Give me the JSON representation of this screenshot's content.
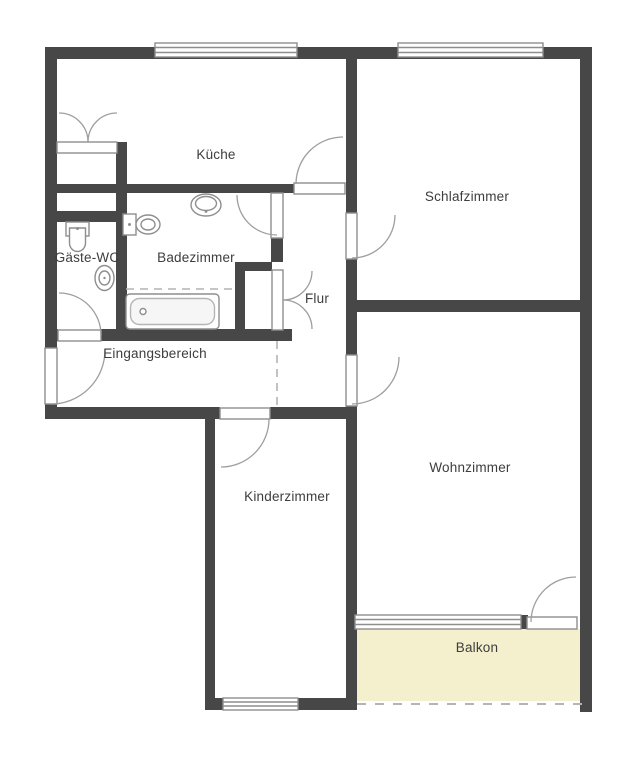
{
  "plan": {
    "type": "apartment-floorplan",
    "rooms": {
      "kueche": {
        "label": "Küche"
      },
      "schlafzimmer": {
        "label": "Schlafzimmer"
      },
      "gaeste_wc": {
        "label": "Gäste-WC"
      },
      "badezimmer": {
        "label": "Badezimmer"
      },
      "flur": {
        "label": "Flur"
      },
      "eingangsbereich": {
        "label": "Eingangsbereich"
      },
      "kinderzimmer": {
        "label": "Kinderzimmer"
      },
      "wohnzimmer": {
        "label": "Wohnzimmer"
      },
      "balkon": {
        "label": "Balkon"
      }
    },
    "colors": {
      "wall": "#474747",
      "frame": "#8e8e8e",
      "arc": "#9e9e9e",
      "fixture": "#8e8e8e",
      "fixture_light": "#b5b5b5",
      "balcony_fill": "#f4efcd",
      "label": "#3d3d3d",
      "dashed": "#b4b4b4",
      "background": "#ffffff"
    }
  }
}
